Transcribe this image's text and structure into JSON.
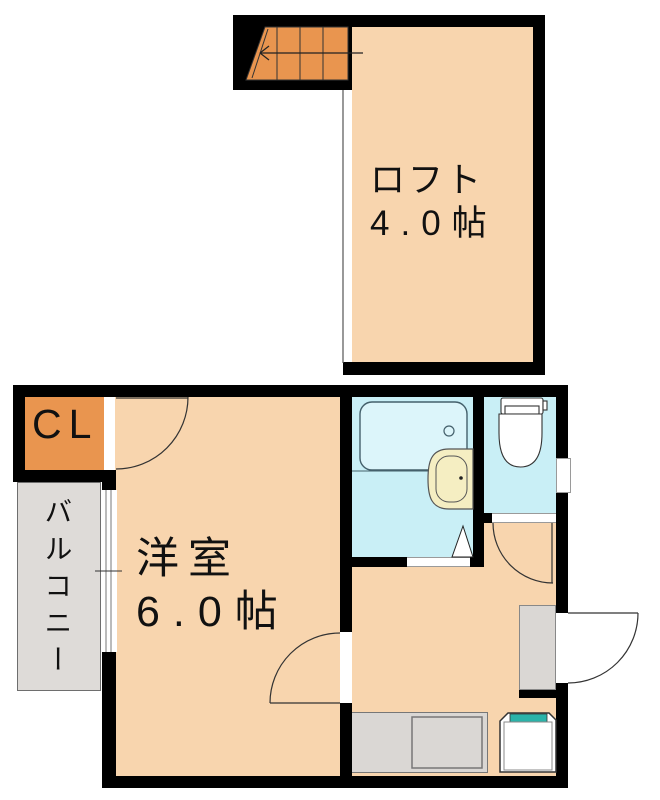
{
  "floorplan": {
    "loft": {
      "label": "ロフト",
      "area": "4.0帖"
    },
    "western_room": {
      "label": "洋室",
      "area": "6.0帖"
    },
    "closet": {
      "label": "CL"
    },
    "balcony": {
      "label": "バルコニー"
    },
    "fixtures": [
      "stairs",
      "down-arrow",
      "bathtub",
      "washbasin",
      "toilet",
      "bath-folding-door",
      "room-door",
      "closet-door",
      "toilet-door",
      "entrance-door",
      "shoe-cabinet",
      "kitchen-counter",
      "kitchen-sink",
      "sliding-window",
      "small-window"
    ]
  },
  "colors": {
    "wall": "#000000",
    "floor": "#F8D5AE",
    "accent": "#E9954F",
    "bath": "#C9EFF6",
    "tub": "#DCF5FA",
    "basin": "#F5EEC2",
    "balcony": "#DEDBD8",
    "counter": "#DAD7D4",
    "teal": "#2BB3A9",
    "line": "#333333"
  }
}
